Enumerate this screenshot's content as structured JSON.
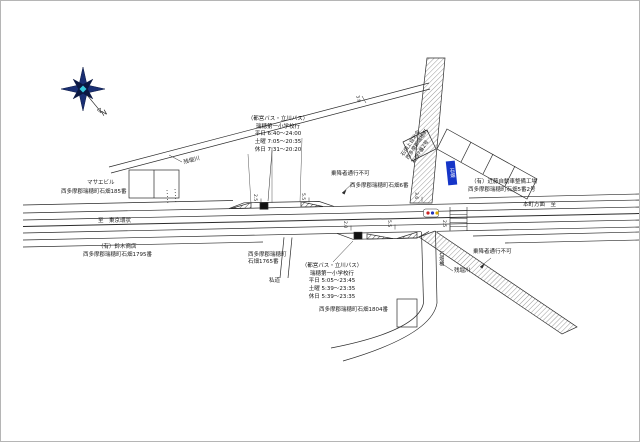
{
  "map_title": "石畑 バス停留所 位置図",
  "colors": {
    "line": "#2a2a2a",
    "hatch": "#222222",
    "sign_blue": "#1535c8",
    "compass_navy": "#1a2f73",
    "compass_dark": "#0a1742",
    "compass_cyan": "#38c9dc",
    "bus_red": "#cc2222",
    "bus_blue": "#2233bb",
    "bus_yellow": "#dda900",
    "marker_black": "#111111"
  },
  "compass": {
    "letter": "N"
  },
  "bus_stop_sign": {
    "text": "石畑"
  },
  "notes": {
    "top": {
      "title": "（都営バス・立川バス）",
      "destination": "瑞穂第一小学校行",
      "weekday": "平日 6:40～24:00",
      "saturday": "土曜 7:05～20:35",
      "holiday": "休日 7:31～20:20"
    },
    "bottom": {
      "title": "（都営バス・立川バス）",
      "destination": "瑞穂第一小学校行",
      "weekday": "平日 5:05～23:45",
      "saturday": "土曜 5:39～23:35",
      "holiday": "休日 5:39～23:35"
    }
  },
  "labels": [
    {
      "id": "mazue-building-name",
      "text": "マサエビル",
      "x": 86,
      "y": 179,
      "size": 5.5
    },
    {
      "id": "mazue-building-addr",
      "text": "西多摩郡瑞穂町石畑185番",
      "x": 60,
      "y": 188,
      "size": 5.5
    },
    {
      "id": "river-label-upper",
      "text": "残堀川",
      "x": 182,
      "y": 159,
      "size": 5.5,
      "rot": -15
    },
    {
      "id": "no-boarding-upper",
      "text": "乗降者通行不可",
      "x": 330,
      "y": 170,
      "size": 5.5
    },
    {
      "id": "addr-ishihata-6",
      "text": "西多摩郡瑞穂町石畑6番",
      "x": 349,
      "y": 182,
      "size": 5.5
    },
    {
      "id": "hall-label",
      "text": "石畑上自治会\n西多摩郡瑞穂町\n石畑7番2号",
      "x": 399,
      "y": 153,
      "size": 5,
      "rot": -56,
      "multiline": true
    },
    {
      "id": "kondo-garage-name",
      "text": "（有）近藤自動車整備工場",
      "x": 470,
      "y": 178,
      "size": 5.5
    },
    {
      "id": "kondo-garage-addr",
      "text": "西多摩郡瑞穂町石畑5番2号",
      "x": 467,
      "y": 186,
      "size": 5.5
    },
    {
      "id": "road-to-left",
      "text": "至　東京環状",
      "x": 97,
      "y": 217,
      "size": 5.5
    },
    {
      "id": "road-to-right",
      "text": "本町方面　至",
      "x": 522,
      "y": 201,
      "size": 5.5
    },
    {
      "id": "suzuki-shop-name",
      "text": "（有）鈴木商店",
      "x": 97,
      "y": 243,
      "size": 5.5
    },
    {
      "id": "suzuki-shop-addr",
      "text": "西多摩郡瑞穂町石畑1795番",
      "x": 82,
      "y": 251,
      "size": 5.5
    },
    {
      "id": "addr-1765",
      "text": "西多摩郡瑞穂町\n石畑1765番",
      "x": 247,
      "y": 251,
      "size": 5.5,
      "multiline": true
    },
    {
      "id": "private-road",
      "text": "私道",
      "x": 268,
      "y": 277,
      "size": 5.5
    },
    {
      "id": "no-boarding-lower",
      "text": "乗降者通行不可",
      "x": 472,
      "y": 248,
      "size": 5.5
    },
    {
      "id": "river-label-lower",
      "text": "残堀川",
      "x": 453,
      "y": 267,
      "size": 5.5
    },
    {
      "id": "bridge-name",
      "text": "石畑橋",
      "x": 437,
      "y": 250,
      "size": 5,
      "vert": true
    },
    {
      "id": "addr-1804",
      "text": "西多摩郡瑞穂町石畑1804番",
      "x": 318,
      "y": 306,
      "size": 5.5
    },
    {
      "id": "north-letter",
      "text": "N",
      "x": 99,
      "y": 110,
      "size": 7,
      "rot": -30
    },
    {
      "id": "dim-1",
      "text": "2.5",
      "x": 256,
      "y": 193,
      "size": 4.5,
      "rot": 90
    },
    {
      "id": "dim-2",
      "text": "5.5",
      "x": 304,
      "y": 192,
      "size": 4.5,
      "rot": 90
    },
    {
      "id": "dim-3",
      "text": "3.6",
      "x": 358,
      "y": 94,
      "size": 4.5,
      "rot": 75
    },
    {
      "id": "dim-4",
      "text": "2.0",
      "x": 346,
      "y": 220,
      "size": 4.5,
      "rot": 90
    },
    {
      "id": "dim-5",
      "text": "5.5",
      "x": 390,
      "y": 219,
      "size": 4.5,
      "rot": 90
    },
    {
      "id": "dim-6",
      "text": "3.6",
      "x": 417,
      "y": 191,
      "size": 4.5,
      "rot": 90
    },
    {
      "id": "dim-7",
      "text": "2.5",
      "x": 445,
      "y": 219,
      "size": 4.5,
      "rot": 90
    }
  ]
}
